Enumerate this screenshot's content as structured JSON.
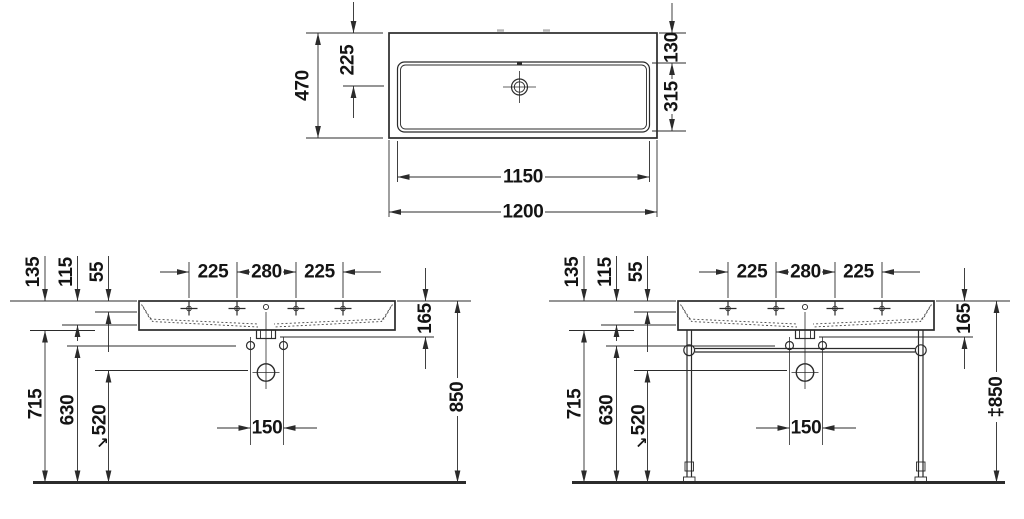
{
  "style": {
    "background": "#ffffff",
    "line_color": "#2b2b2b",
    "text_color": "#141414",
    "faint_mark_color": "#b5b5b5"
  },
  "plan_view": {
    "label_overall_width": "1200",
    "label_inner_width": "1150",
    "label_overall_depth": "470",
    "label_drain_from_rear": "225",
    "label_rear_deck": "130",
    "label_bowl_inner_depth": "315"
  },
  "front_wall_view": {
    "tap_spacing": [
      "225",
      "280",
      "225"
    ],
    "edge_heights": [
      "135",
      "115",
      "55"
    ],
    "label_outlet_detail": "165",
    "label_fixing_hole_spacing": "150",
    "label_h_basin_bottom": "715",
    "label_h_fixing_holes": "630",
    "label_h_outlet": "520",
    "outlet_direction_symbol": "↘",
    "label_h_rim": "850"
  },
  "front_console_view": {
    "tap_spacing": [
      "225",
      "280",
      "225"
    ],
    "edge_heights": [
      "135",
      "115",
      "55"
    ],
    "label_outlet_detail": "165",
    "label_fixing_hole_spacing": "150",
    "label_h_basin_bottom": "715",
    "label_h_fixing_holes": "630",
    "label_h_outlet": "520",
    "outlet_direction_symbol": "↘",
    "label_h_rim": "‡850"
  }
}
